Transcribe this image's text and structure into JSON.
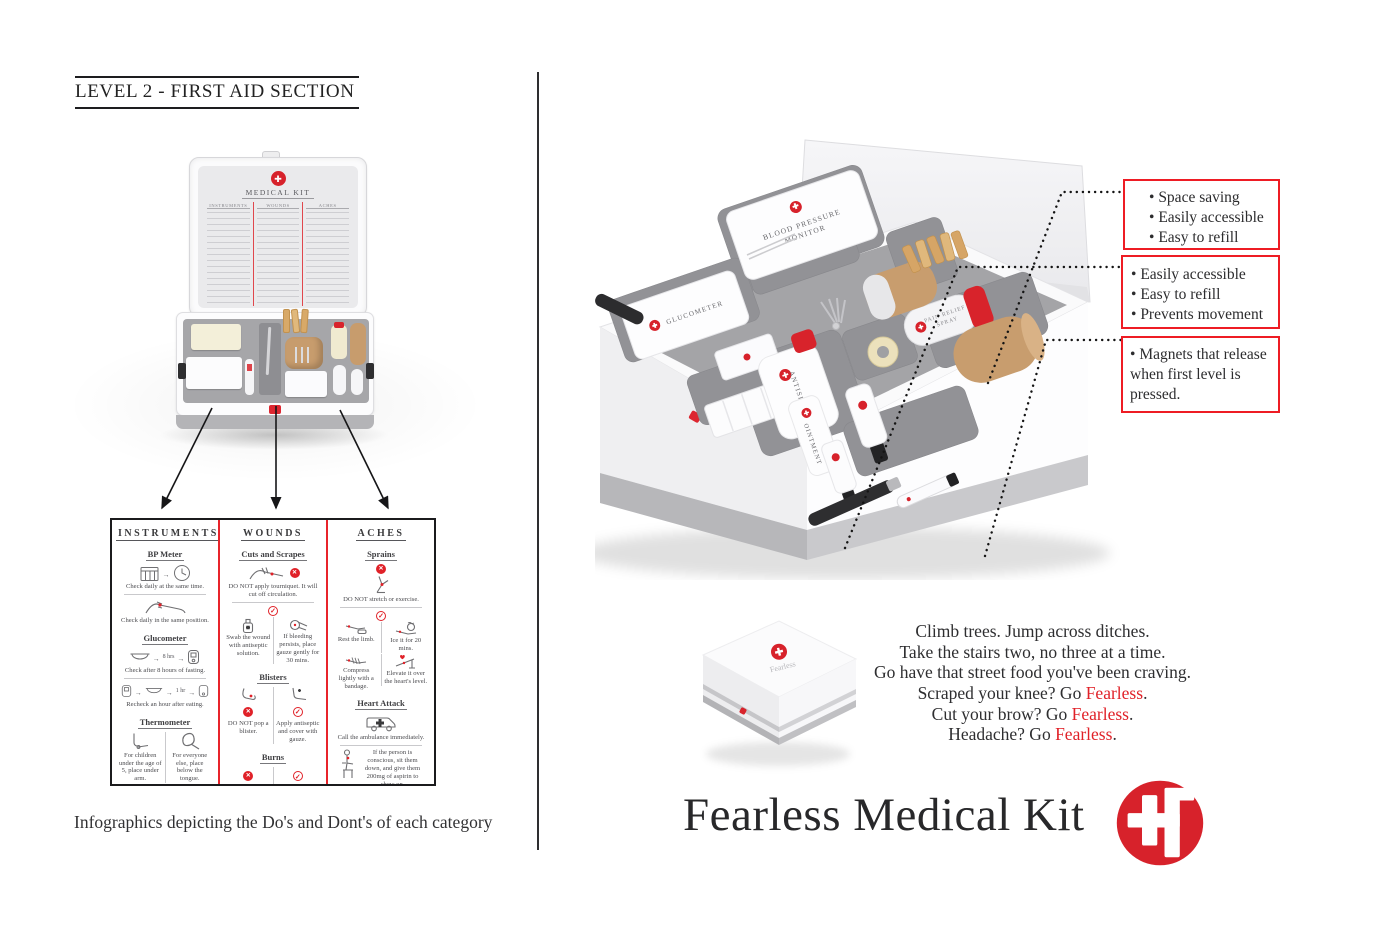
{
  "colors": {
    "accent_red": "#e02128",
    "logo_red": "#d7222b",
    "callout_border_red": "#ee1c24",
    "tray_gray": "#a4a4a7",
    "tan": "#c89d6e",
    "text_dark": "#2d2d2f"
  },
  "left": {
    "title": "LEVEL 2 - FIRST AID SECTION",
    "caption": "Infographics depicting the Do's and Dont's of each category",
    "lid": {
      "kit_title": "MEDICAL KIT",
      "columns": [
        "INSTRUMENTS",
        "WOUNDS",
        "ACHES"
      ]
    },
    "infographic": {
      "columns": [
        {
          "header": "INSTRUMENTS",
          "sections": [
            {
              "title": "BP Meter",
              "cells": [
                {
                  "caption": "Check daily at the same time."
                },
                {
                  "caption": "Check daily in the same position."
                }
              ]
            },
            {
              "title": "Glucometer",
              "cells": [
                {
                  "label": "8 hrs",
                  "caption": "Check after 8 hours of fasting."
                },
                {
                  "label": "1 hr",
                  "caption": "Recheck an hour after eating."
                }
              ]
            },
            {
              "title": "Thermometer",
              "cells": [
                {
                  "caption": "For children under the age of 5, place under arm."
                },
                {
                  "caption": "For everyone else, place below the tongue."
                }
              ]
            }
          ]
        },
        {
          "header": "WOUNDS",
          "sections": [
            {
              "title": "Cuts and Scrapes",
              "cells": [
                {
                  "caption": "DO NOT apply tourniquet. It will cut off circulation."
                },
                {
                  "caption": "Swab the wound with antiseptic solution."
                },
                {
                  "caption": "If bleeding persists, place gauze gently for 30 mins."
                }
              ]
            },
            {
              "title": "Blisters",
              "cells": [
                {
                  "caption": "DO NOT pop a blister."
                },
                {
                  "caption": "Apply antiseptic and cover with gauze."
                }
              ]
            },
            {
              "title": "Burns",
              "cells": [
                {
                  "caption": "DO NOT wash with ice."
                },
                {
                  "caption": "Hold burn under running water for 20 mins."
                }
              ]
            },
            {
              "title": "Snake bites",
              "cells": [
                {
                  "caption": "DO NOT cut, suck or squeeze."
                },
                {
                  "caption": "RUSH TO THE HOSPITAL."
                }
              ]
            }
          ]
        },
        {
          "header": "ACHES",
          "sections": [
            {
              "title": "Sprains",
              "cells": [
                {
                  "caption": "DO NOT stretch or exercise."
                },
                {
                  "caption": "Rest the limb."
                },
                {
                  "caption": "Ice it for 20 mins."
                },
                {
                  "caption": "Compress lightly with a bandage."
                },
                {
                  "caption": "Elevate it over the heart's level."
                }
              ]
            },
            {
              "title": "Heart Attack",
              "cells": [
                {
                  "caption": "Call the ambulance immediately."
                },
                {
                  "caption": "If the person is conscious, sit them down, and give them 200mg of aspirin to chew on."
                }
              ]
            }
          ]
        }
      ]
    }
  },
  "right": {
    "callouts": [
      {
        "items": [
          "Space saving",
          "Easily accessible",
          "Easy to refill"
        ]
      },
      {
        "items": [
          "Easily accessible",
          "Easy to refill",
          "Prevents movement"
        ]
      },
      {
        "items": [
          "Magnets that release when first level is pressed."
        ]
      }
    ],
    "kit": {
      "bp_line1": "BLOOD PRESSURE",
      "bp_line2": "MONITOR",
      "glucometer": "GLUCOMETER",
      "antiseptic": "ANTISEPTIC",
      "ointment": "OINTMENT",
      "spray_line1": "PAIN RELIEF",
      "spray_line2": "SPRAY"
    },
    "closed_box": {
      "label": "Fearless"
    },
    "tagline": {
      "lines": [
        "Climb trees. Jump across ditches.",
        "Take the stairs two, no three at a time.",
        "Go have that street food you've been craving."
      ],
      "cta": [
        {
          "pre": "Scraped your knee? Go ",
          "accent": "Fearless",
          "suf": "."
        },
        {
          "pre": "Cut your brow? Go ",
          "accent": "Fearless",
          "suf": "."
        },
        {
          "pre": "Headache? Go ",
          "accent": "Fearless",
          "suf": "."
        }
      ]
    },
    "brand": {
      "title": "Fearless Medical Kit"
    }
  }
}
